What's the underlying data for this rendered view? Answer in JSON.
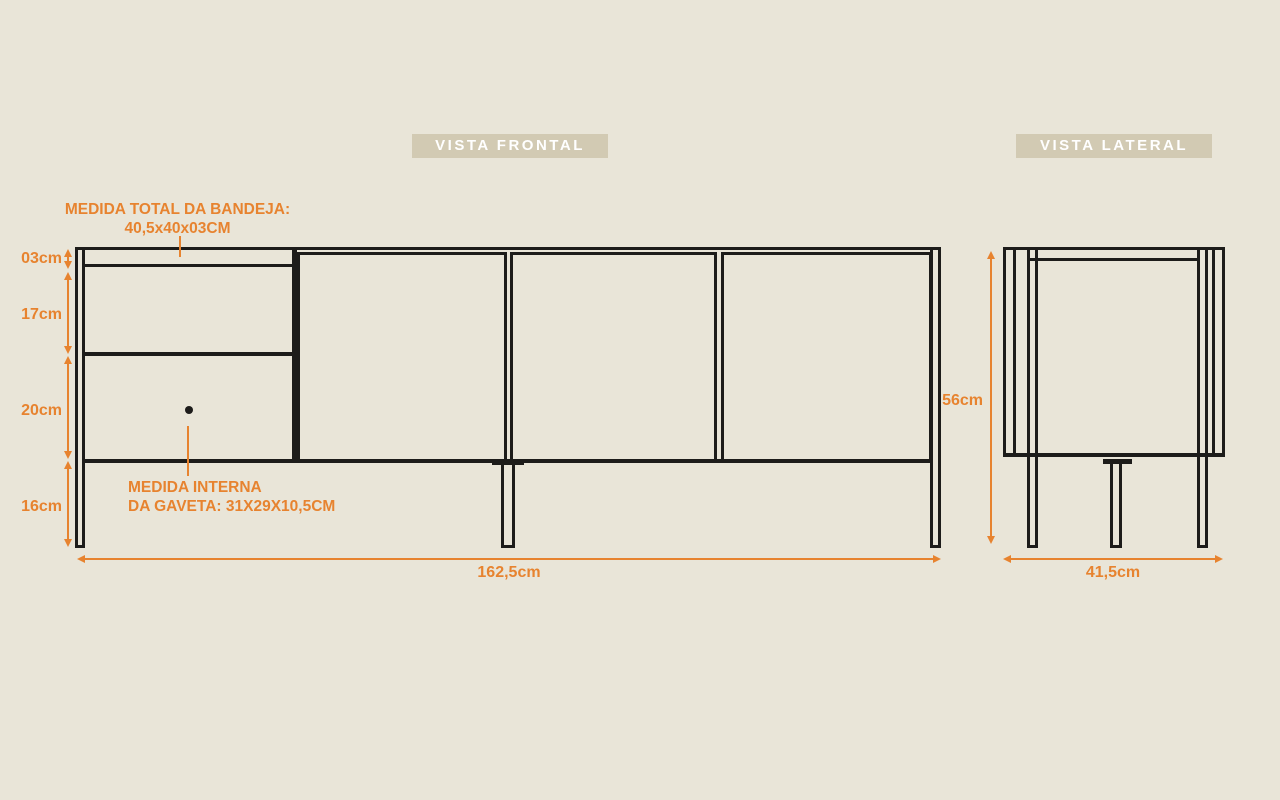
{
  "colors": {
    "background": "#E9E5D8",
    "accent_orange": "#E7832F",
    "ink": "#1D1C1A",
    "badge_bg": "#D2CAB3",
    "badge_text": "#FFFFFF"
  },
  "views": {
    "frontal": {
      "title": "VISTA FRONTAL",
      "annotations": {
        "bandeja_line1": "MEDIDA TOTAL DA BANDEJA:",
        "bandeja_line2": "40,5x40x03CM",
        "gaveta_line1": "MEDIDA INTERNA",
        "gaveta_line2": "DA GAVETA: 31X29X10,5CM"
      },
      "dimensions": {
        "left_stack": [
          {
            "label": "03cm"
          },
          {
            "label": "17cm"
          },
          {
            "label": "20cm"
          },
          {
            "label": "16cm"
          }
        ],
        "width": "162,5cm"
      }
    },
    "lateral": {
      "title": "VISTA LATERAL",
      "dimensions": {
        "height": "56cm",
        "width": "41,5cm"
      }
    }
  }
}
